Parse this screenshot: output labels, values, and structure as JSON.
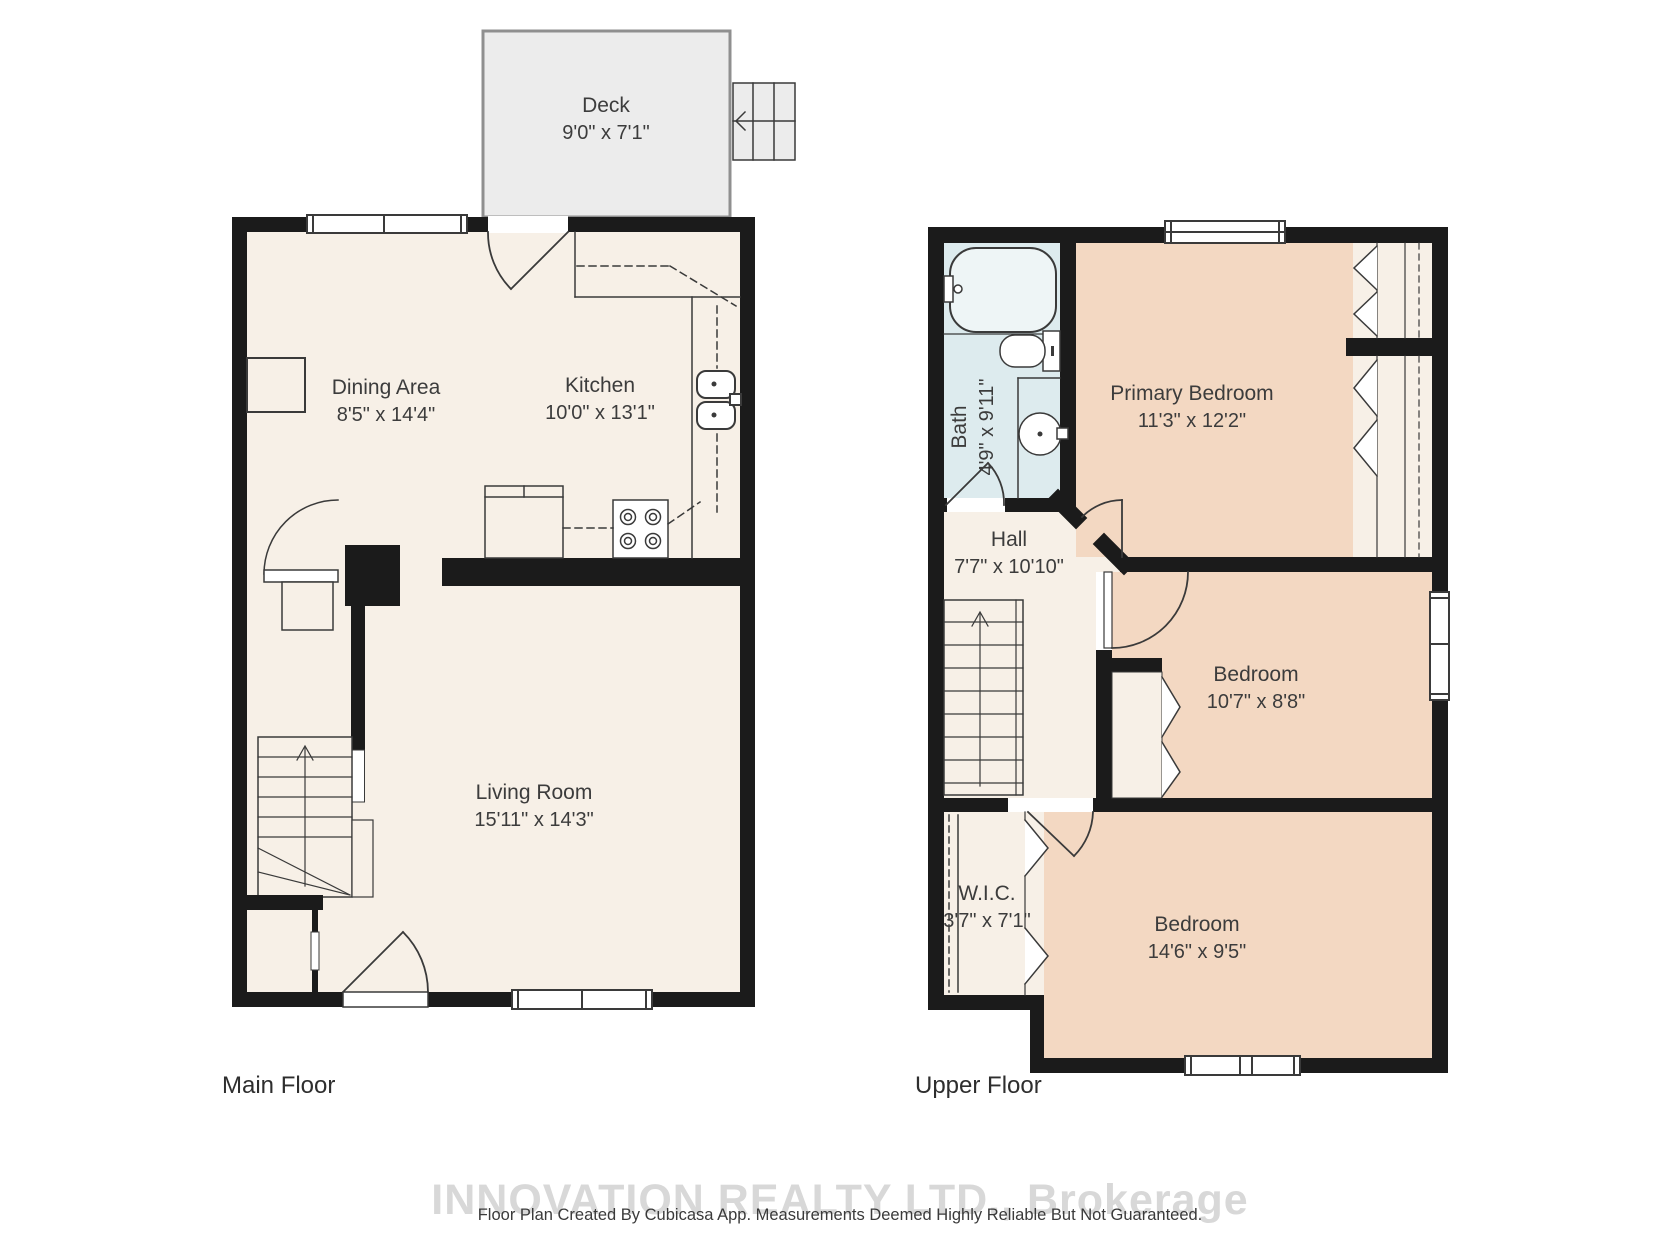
{
  "main_floor": {
    "label": "Main Floor",
    "rooms": {
      "deck": {
        "name": "Deck",
        "dims": "9'0\" x 7'1\""
      },
      "dining": {
        "name": "Dining Area",
        "dims": "8'5\" x 14'4\""
      },
      "kitchen": {
        "name": "Kitchen",
        "dims": "10'0\" x 13'1\""
      },
      "living": {
        "name": "Living Room",
        "dims": "15'11\" x 14'3\""
      }
    }
  },
  "upper_floor": {
    "label": "Upper Floor",
    "rooms": {
      "bath": {
        "name": "Bath",
        "dims": "4'9\" x 9'11\""
      },
      "primary_bedroom": {
        "name": "Primary Bedroom",
        "dims": "11'3\" x 12'2\""
      },
      "hall": {
        "name": "Hall",
        "dims": "7'7\" x 10'10\""
      },
      "bedroom_middle": {
        "name": "Bedroom",
        "dims": "10'7\" x 8'8\""
      },
      "wic": {
        "name": "W.I.C.",
        "dims": "3'7\" x 7'1\""
      },
      "bedroom_lower": {
        "name": "Bedroom",
        "dims": "14'6\" x 9'5\""
      }
    }
  },
  "footer": {
    "watermark": "INNOVATION REALTY LTD., Brokerage",
    "disclaimer": "Floor Plan Created By Cubicasa App. Measurements Deemed Highly Reliable But Not Guaranteed."
  },
  "colors": {
    "wall": "#1b1b1b",
    "floor_fill": "#f7f0e7",
    "bedroom_fill": "#f3d8c2",
    "bath_fill": "#ddebee",
    "deck_fill": "#ececec",
    "line": "#3a3a3a",
    "watermark_gray": "#d8d8d8"
  }
}
